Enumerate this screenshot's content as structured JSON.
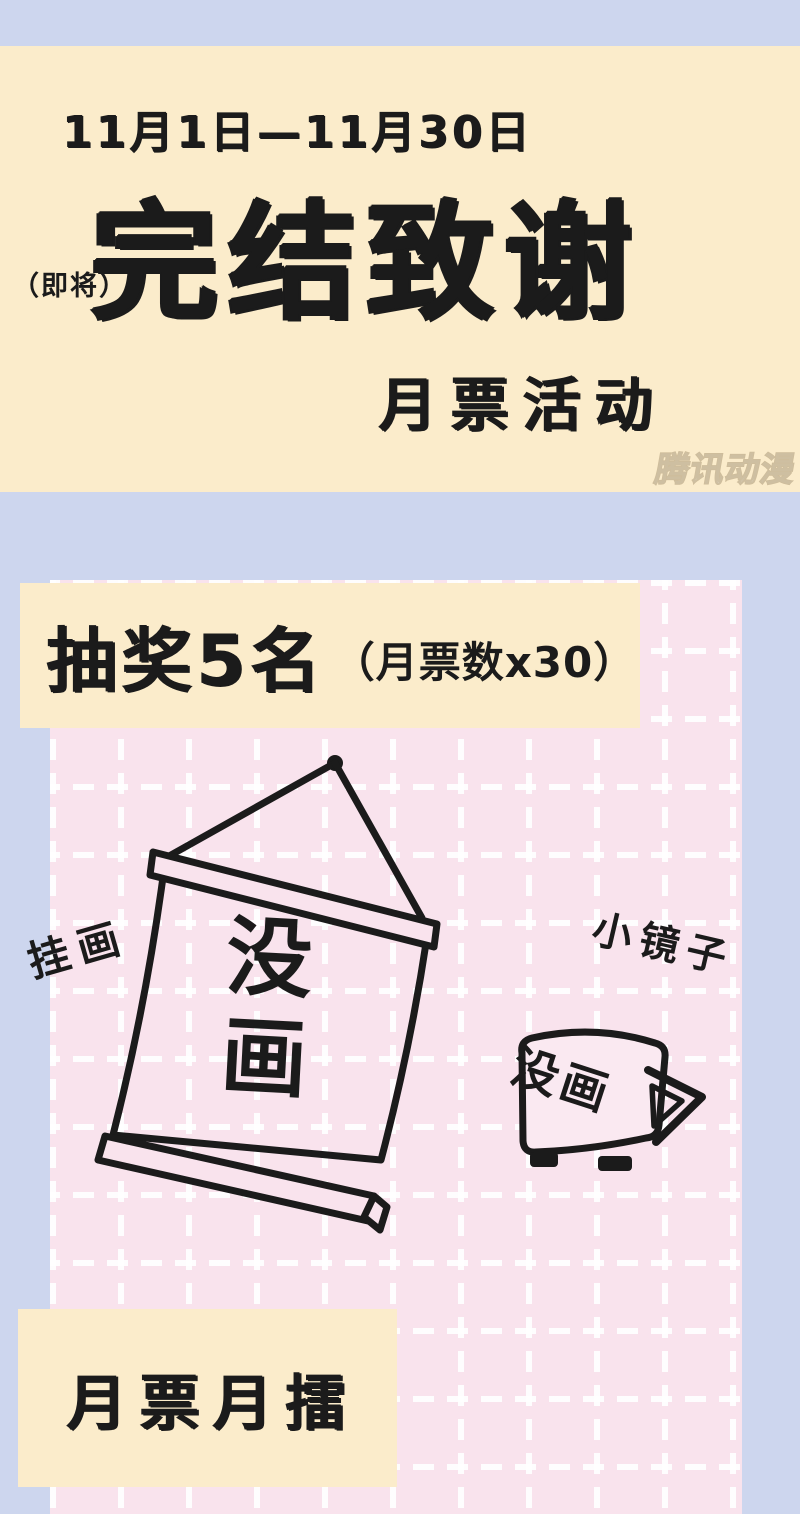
{
  "poster": {
    "colors": {
      "background_lavender": "#cdd6ee",
      "banner_cream": "#fbeccb",
      "panel_pink": "#f9e3ed",
      "grid_line_white": "#ffffff",
      "ink_black": "#1b1b1b"
    },
    "header": {
      "date_range": "11月1日—11月30日",
      "title_prefix": "（即将）",
      "title": "完结致谢",
      "subtitle": "月票活动",
      "watermark": "腾讯动漫"
    },
    "lottery_banner": {
      "main": "抽奖5名",
      "note": "（月票数x30）"
    },
    "prizes": {
      "hanging_scroll": {
        "label": "挂画",
        "note": "没画"
      },
      "mirror": {
        "label": "小镜子",
        "note": "没画"
      }
    },
    "footer_banner": {
      "text": "月票月擂"
    }
  }
}
